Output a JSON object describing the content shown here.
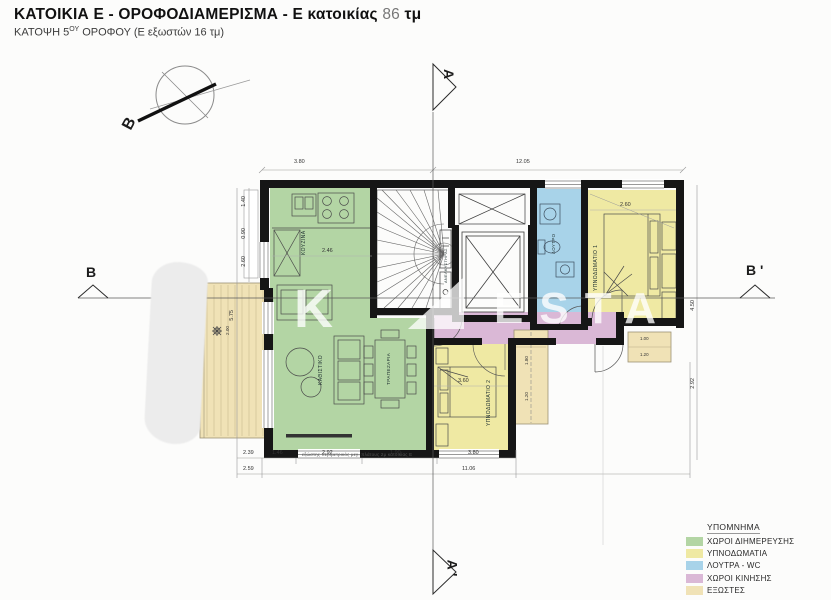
{
  "header": {
    "title": "ΚΑΤΟΙΚΙΑ Ε - ΟΡΟΦΟΔΙΑΜΕΡΙΣΜΑ - Ε κατοικίας",
    "area": "86",
    "unit": "τμ",
    "subtitle_pre": "ΚΑΤΟΨΗ 5",
    "subtitle_sup": "ΟΥ",
    "subtitle_post": " ΟΡΟΦΟΥ (Ε εξωστών 16 τμ)"
  },
  "compass": {
    "north_label": "B"
  },
  "sections": {
    "top": "A",
    "bottom": "A '",
    "left": "B",
    "right": "B '"
  },
  "rooms": {
    "kitchen": "ΚΟΥΖΙΝΑ",
    "living": "ΚΑΘΙΣΤΙΚΟ",
    "dining": "ΤΡΑΠΕΖΑΡΙΑ",
    "bedroom1": "ΥΠΝΟΔΩΜΑΤΙΟ 1",
    "bedroom2": "ΥΠΝΟΔΩΜΑΤΙΟ 2",
    "bathroom": "ΛΟΥΤΡΟ",
    "elevator": "ΑΝΕΛΚΥΣΤΗΡΑΣ"
  },
  "dimensions": {
    "top_left": "3.80",
    "top_right": "12.05",
    "bottom": [
      "2.39",
      "1.46",
      "2.92",
      "1.90",
      "3.80"
    ],
    "bottom_total_left": "2.59",
    "bottom_total_right": "11.06",
    "left": [
      "1.40",
      "0.90",
      "2.60"
    ],
    "left_total": "5.75",
    "right_upper": "4.50",
    "right_lower": "2.92",
    "kitchen": "2.46",
    "bed1": "2.60",
    "bed2": "3.60",
    "strip": [
      "1.80",
      "1.20"
    ],
    "small_balcony": [
      "1.00",
      "1.20"
    ],
    "left_balcony": "2.00",
    "note": "εξώστης περιμετρικός μεγ. πλάτους 2μ κατοικίας Ε"
  },
  "watermark": {
    "mark": "K",
    "word": "ΕSTA"
  },
  "legend": {
    "title": "ΥΠΟΜΝΗΜΑ",
    "items": [
      {
        "label": "ΧΩΡΟΙ ΔΙΗΜΕΡΕΥΣΗΣ",
        "color": "#b3d5a4"
      },
      {
        "label": "ΥΠΝΟΔΩΜΑΤΙΑ",
        "color": "#efe9a3"
      },
      {
        "label": "ΛΟΥΤΡΑ - WC",
        "color": "#a8d3e9"
      },
      {
        "label": "ΧΩΡΟΙ ΚΙΝΗΣΗΣ",
        "color": "#dab8d6"
      },
      {
        "label": "ΕΞΩΣΤΕΣ",
        "color": "#f0e2b6"
      }
    ]
  }
}
